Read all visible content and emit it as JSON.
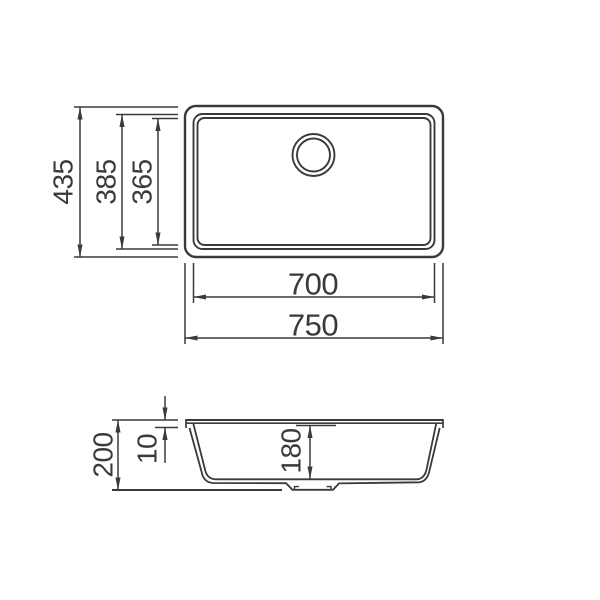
{
  "drawing": {
    "type": "sink technical dimension drawing",
    "colors": {
      "line": "#3a3a3a",
      "text": "#3a3a3a",
      "background": "#ffffff"
    },
    "top_view": {
      "dims": {
        "overall_height": "435",
        "bowl_outer_height": "385",
        "bowl_inner_height": "365",
        "bowl_width": "700",
        "overall_width": "750"
      }
    },
    "side_view": {
      "dims": {
        "overall_depth": "200",
        "rim_thickness": "10",
        "bowl_depth": "180"
      }
    }
  }
}
